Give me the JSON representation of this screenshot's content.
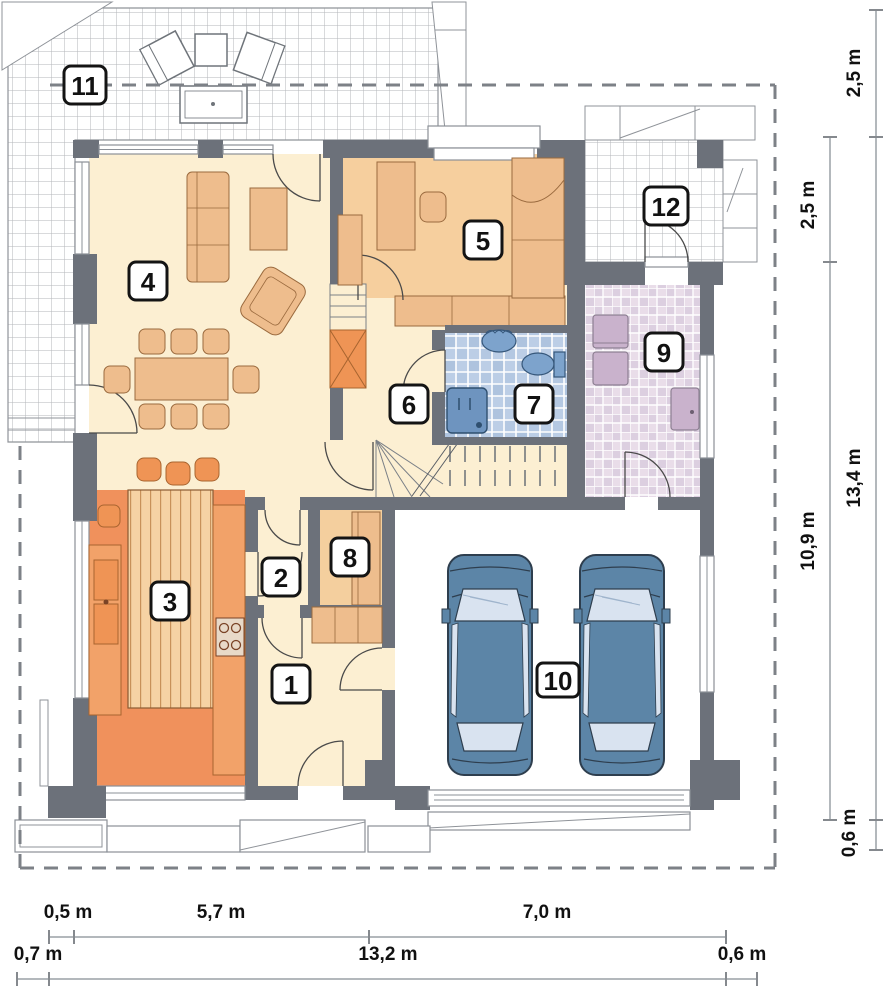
{
  "drawing": {
    "type": "architectural-floor-plan",
    "rooms": [
      {
        "number": "1"
      },
      {
        "number": "2"
      },
      {
        "number": "3"
      },
      {
        "number": "4"
      },
      {
        "number": "5"
      },
      {
        "number": "6"
      },
      {
        "number": "7"
      },
      {
        "number": "8"
      },
      {
        "number": "9"
      },
      {
        "number": "10"
      },
      {
        "number": "11"
      },
      {
        "number": "12"
      }
    ],
    "dimensions": {
      "right_outer": [
        {
          "label": "2,5 m"
        },
        {
          "label": "13,4 m"
        },
        {
          "label": "0,6 m"
        }
      ],
      "right_inner": [
        {
          "label": "2,5 m"
        },
        {
          "label": "10,9 m"
        }
      ],
      "bottom_row1": [
        {
          "label": "0,5 m"
        },
        {
          "label": "5,7 m"
        },
        {
          "label": "7,0 m"
        }
      ],
      "bottom_row2": [
        {
          "label": "0,7 m"
        },
        {
          "label": "13,2 m"
        },
        {
          "label": "0,6 m"
        }
      ]
    },
    "colors": {
      "wall": "#6c717a",
      "floor_cream": "#fcefd2",
      "floor_peach": "#f6cf9e",
      "floor_kitchen": "#f0915c",
      "furniture_tan": "#eebd8d",
      "furniture_orange": "#ef9455",
      "tile_blue": "#bccee6",
      "tile_pink": "#e2d5e3",
      "car_blue": "#5c85a7",
      "dimension_text": "#111111"
    }
  }
}
